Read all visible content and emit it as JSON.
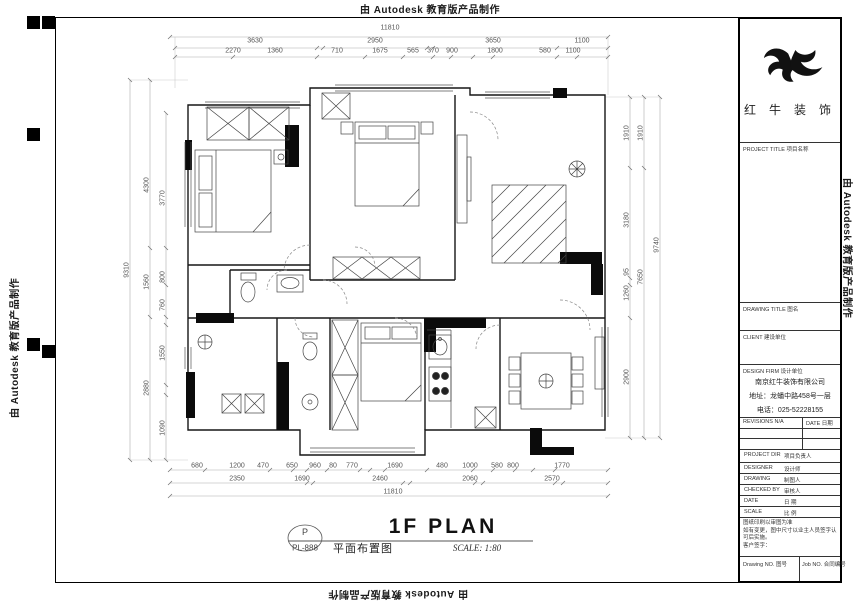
{
  "edge": {
    "autodesk_note": "由 Autodesk 教育版产品制作"
  },
  "titleblock": {
    "logo_name": "红 牛 装 饰",
    "project_title_row": "PROJECT TITLE  项目名称",
    "drawing_title_row": "DRAWING TITLE  图名",
    "client_row": "CLIENT  建设单位",
    "design_firm_row": "DESIGN FIRM  设计单位",
    "company_name": "南京红牛装饰有限公司",
    "company_address": "地址：龙蟠中路458号一层",
    "company_phone": "电话：025-52228155",
    "revisions_label": "REVISIONS  N/A",
    "date_header": "DATE  日期",
    "fields": [
      {
        "en": "PROJECT DIR",
        "cn": "项目负责人"
      },
      {
        "en": "DESIGNER",
        "cn": "设计师"
      },
      {
        "en": "DRAWING",
        "cn": "制图人"
      },
      {
        "en": "CHECKED BY",
        "cn": "审核人"
      },
      {
        "en": "DATE",
        "cn": "日 期"
      },
      {
        "en": "SCALE",
        "cn": "比 例"
      }
    ],
    "notes": [
      "图纸印刷以审图为准",
      "如有变更，图中尺寸以业主人员签字认可后实施。",
      "客户签字："
    ],
    "drawing_no_label": "Drawing NO. 图号",
    "job_no_label": "Job NO. 合同编号"
  },
  "plan_title": {
    "tag_letter": "P",
    "tag_code": "PL-888",
    "cn_title": "平面布置图",
    "en_title": "1F PLAN",
    "scale": "SCALE: 1:80"
  },
  "dims": {
    "top_total": "11810",
    "top_mid": [
      "3630",
      "2950",
      "3650",
      "1100"
    ],
    "top_fine": [
      "2270",
      "1360",
      "710",
      "1675",
      "565",
      "370",
      "900",
      "1800",
      "580",
      "1100"
    ],
    "bottom_fine": [
      "680",
      "1200",
      "470",
      "650",
      "960",
      "80",
      "770",
      "1690",
      "480",
      "1000",
      "580",
      "800",
      "1770"
    ],
    "bottom_mid": [
      "2350",
      "1690",
      "2460",
      "2060",
      "2570"
    ],
    "bottom_total": "11810",
    "left_outer": "9310",
    "left_mid": [
      "4300",
      "1560",
      "2880"
    ],
    "left_fine": [
      "3770",
      "800",
      "760",
      "1550",
      "1090"
    ],
    "right_fine": [
      "1910",
      "3180",
      "95",
      "1260",
      "2900"
    ],
    "right_mid": [
      "1910",
      "7650"
    ],
    "right_outer": "9740"
  }
}
